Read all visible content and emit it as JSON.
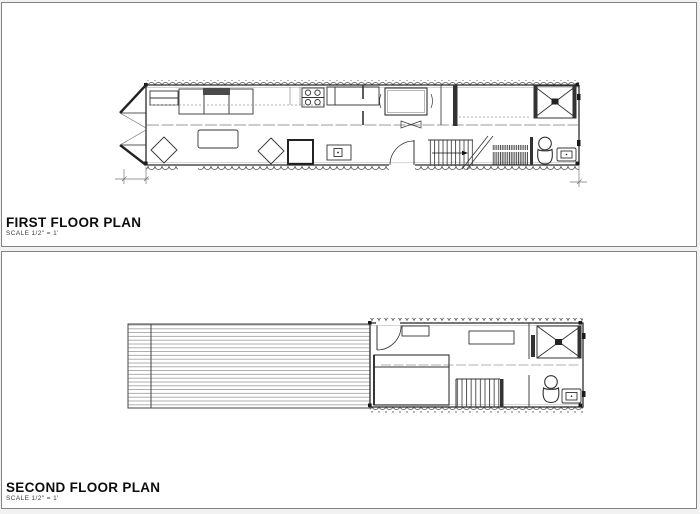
{
  "sheet": {
    "background": "#f2f2f2",
    "panel_background": "#ffffff",
    "panel_border_color": "#838383",
    "line_color": "#2b2b2b",
    "muted_line_color": "#999999",
    "text_color": "#0d0d0d"
  },
  "first_floor": {
    "title": "FIRST FLOOR PLAN",
    "scale_note": "SCALE  1/2\" = 1'"
  },
  "second_floor": {
    "title": "SECOND FLOOR PLAN",
    "scale_note": "SCALE  1/2\" = 1'"
  }
}
